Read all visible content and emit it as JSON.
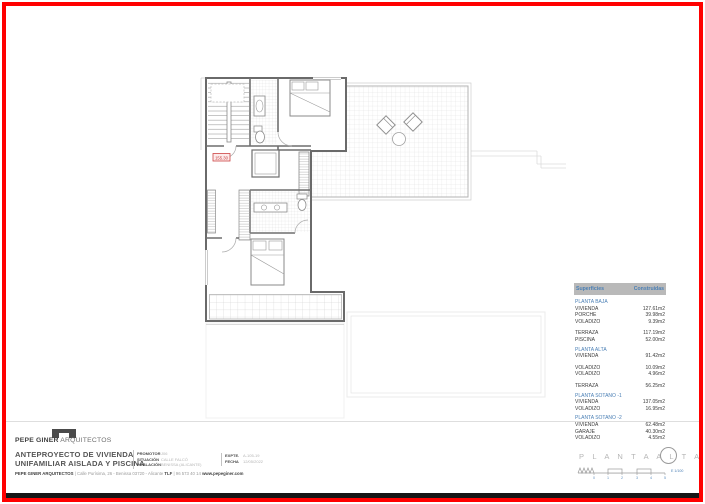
{
  "colors": {
    "frame": "#ff0000",
    "accent_blue": "#4a7fb5",
    "table_header_bg": "#b9b9b9",
    "label_red": "#c23b3b"
  },
  "plan": {
    "level_label": "155.30"
  },
  "areas_table": {
    "header": {
      "col1": "Superficies",
      "col2": "Construidas"
    },
    "rows": [
      {
        "label": "PLANTA BAJA",
        "value": ""
      },
      {
        "label": "VIVIENDA",
        "value": "127.61m2"
      },
      {
        "label": "PORCHE",
        "value": "39.98m2"
      },
      {
        "label": "VOLADIZO",
        "value": "9.39m2"
      },
      {
        "label": "TERRAZA",
        "value": "117.19m2"
      },
      {
        "label": "PISCINA",
        "value": "52.00m2"
      },
      {
        "label": "PLANTA ALTA",
        "value": ""
      },
      {
        "label": "VIVIENDA",
        "value": "91.42m2"
      },
      {
        "label": "VOLADIZO",
        "value": "10.09m2"
      },
      {
        "label": "VOLADIZO",
        "value": "4.96m2"
      },
      {
        "label": "TERRAZA",
        "value": "56.25m2"
      },
      {
        "label": "PLANTA SOTANO -1",
        "value": ""
      },
      {
        "label": "VIVIENDA",
        "value": "137.05m2"
      },
      {
        "label": "VOLADIZO",
        "value": "16.95m2"
      },
      {
        "label": "PLANTA SOTANO -2",
        "value": ""
      },
      {
        "label": "VIVIENDA",
        "value": "62.48m2"
      },
      {
        "label": "GARAJE",
        "value": "40.30m2"
      },
      {
        "label": "VOLADIZO",
        "value": "4.55m2"
      }
    ]
  },
  "title_block": {
    "firm_bold": "PEPE GINER",
    "firm_light": " ARQUITECTOS",
    "project_line1": "ANTEPROYECTO DE VIVIENDA",
    "project_line2": "UNIFAMILIAR AISLADA Y PISCINA",
    "addr_b1": "PEPE GINER ARQUITECTOS",
    "addr_r1": " | Calle Purísima, 26 - Benissa 03720 - Alicante ",
    "addr_b2": "TLF",
    "addr_r2": " | 96 573 40 14 ",
    "addr_b3": "www.pepeginer.com",
    "fields": {
      "promotor_label": "PROMOTOR",
      "promotor_value": "J06",
      "situacion_label": "SITUACIÓN",
      "situacion_value": "CALLE FALCÓ",
      "poblacion_label": "POBLACIÓN",
      "poblacion_value": "BENISSA (ALICANTE)",
      "expte_label": "EXPTE.",
      "expte_value": "A-105-19",
      "fecha_label": "FECHA",
      "fecha_value": "12/05/2022"
    }
  },
  "sheet_footer": {
    "plan_label": "P L A N T A   A L T A",
    "scale_label": "E 1/100",
    "scale_ticks": [
      "0",
      "1",
      "2",
      "3",
      "4",
      "5"
    ]
  }
}
